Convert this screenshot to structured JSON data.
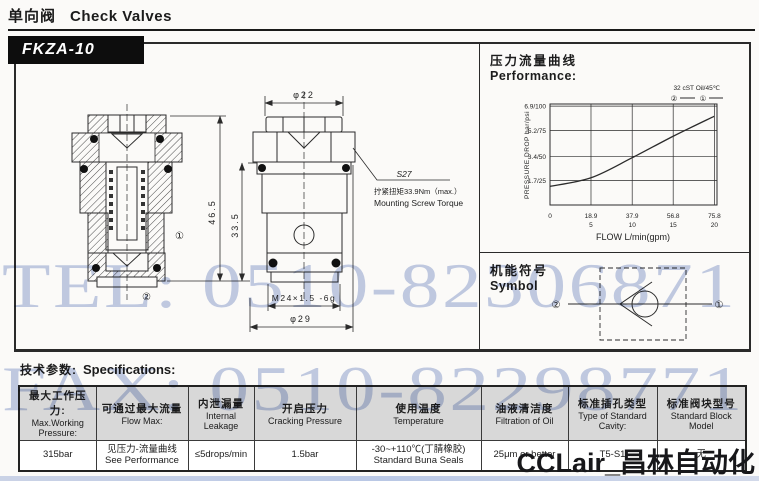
{
  "page": {
    "header_cn": "单向阀",
    "header_en": "Check Valves",
    "model": "FKZA-10",
    "watermark_tel": "TEL: 0510-82306871",
    "watermark_fax": "FAX: 0510-82298771",
    "watermark_brand": "CCLair_昌林自动化",
    "colors": {
      "watermark_blue": "#8fa2d2",
      "table_header_gray": "#d8d8d8",
      "line_art": "#2b2b2b"
    }
  },
  "drawing": {
    "dim_total_height": "46.5",
    "dim_body_height": "33.5",
    "dim_top_diameter": "φ22",
    "dim_bottom_diameter": "φ29",
    "thread": "M24×1.5 -6g",
    "port1": "①",
    "port2": "②",
    "torque_code": "S27",
    "torque_cn": "拧紧扭矩33.9Nm（max.）",
    "torque_en": "Mounting Screw Torque"
  },
  "performance": {
    "title_cn": "压力流量曲线",
    "title_en": "Performance:",
    "legend_oil": "32 cST Oil/45℃",
    "legend_curve2": "②",
    "legend_curve1": "①"
  },
  "chart_data": {
    "type": "line",
    "title": "压力流量曲线 Performance",
    "xlabel": "FLOW L/min(gpm)",
    "ylabel": "PRESSURE DROP bar/psi",
    "x": [
      0,
      18.9,
      37.9,
      56.8,
      75.8
    ],
    "x_ticks_lmin": [
      "0",
      "18.9",
      "37.9",
      "56.8",
      "75.8"
    ],
    "x_ticks_gpm": [
      "",
      "5",
      "10",
      "15",
      "20"
    ],
    "y_ticks": [
      "6.9/100",
      "5.2/75",
      "3.4/50",
      "1.7/25"
    ],
    "y_tick_values": [
      6.9,
      5.2,
      3.4,
      1.7
    ],
    "series": [
      {
        "name": "32 cST Oil/45℃ (curves ① and ②)",
        "values": [
          1.3,
          1.9,
          3.3,
          4.8,
          6.2
        ]
      }
    ],
    "xlim": [
      0,
      77
    ],
    "ylim": [
      0,
      7.05
    ],
    "grid": true,
    "legend_position": "top-right"
  },
  "symbol": {
    "title_cn": "机能符号",
    "title_en": "Symbol",
    "port1": "①",
    "port2": "②"
  },
  "specs": {
    "title_cn": "技术参数:",
    "title_en": "Specifications:",
    "columns": [
      {
        "cn": "最大工作压力:",
        "en": "Max.Working Pressure:"
      },
      {
        "cn": "可通过最大流量",
        "en": "Flow Max:"
      },
      {
        "cn": "内泄漏量",
        "en": "Internal Leakage"
      },
      {
        "cn": "开启压力",
        "en": "Cracking Pressure"
      },
      {
        "cn": "使用温度",
        "en": "Temperature"
      },
      {
        "cn": "油液清洁度",
        "en": "Filtration of Oil"
      },
      {
        "cn": "标准插孔类型",
        "en": "Type of Standard Cavity:"
      },
      {
        "cn": "标准阀块型号",
        "en": "Standard Block Model"
      }
    ],
    "values": [
      {
        "l1": "315bar",
        "l2": ""
      },
      {
        "l1": "见压力-流量曲线",
        "l2": "See Performance"
      },
      {
        "l1": "≤5drops/min",
        "l2": ""
      },
      {
        "l1": "1.5bar",
        "l2": ""
      },
      {
        "l1": "-30~+110℃(丁腈橡胶)",
        "l2": "Standard Buna Seals"
      },
      {
        "l1": "25μm or better",
        "l2": ""
      },
      {
        "l1": "T5-S1",
        "l2": ""
      },
      {
        "l1": "无",
        "l2": ""
      }
    ]
  }
}
